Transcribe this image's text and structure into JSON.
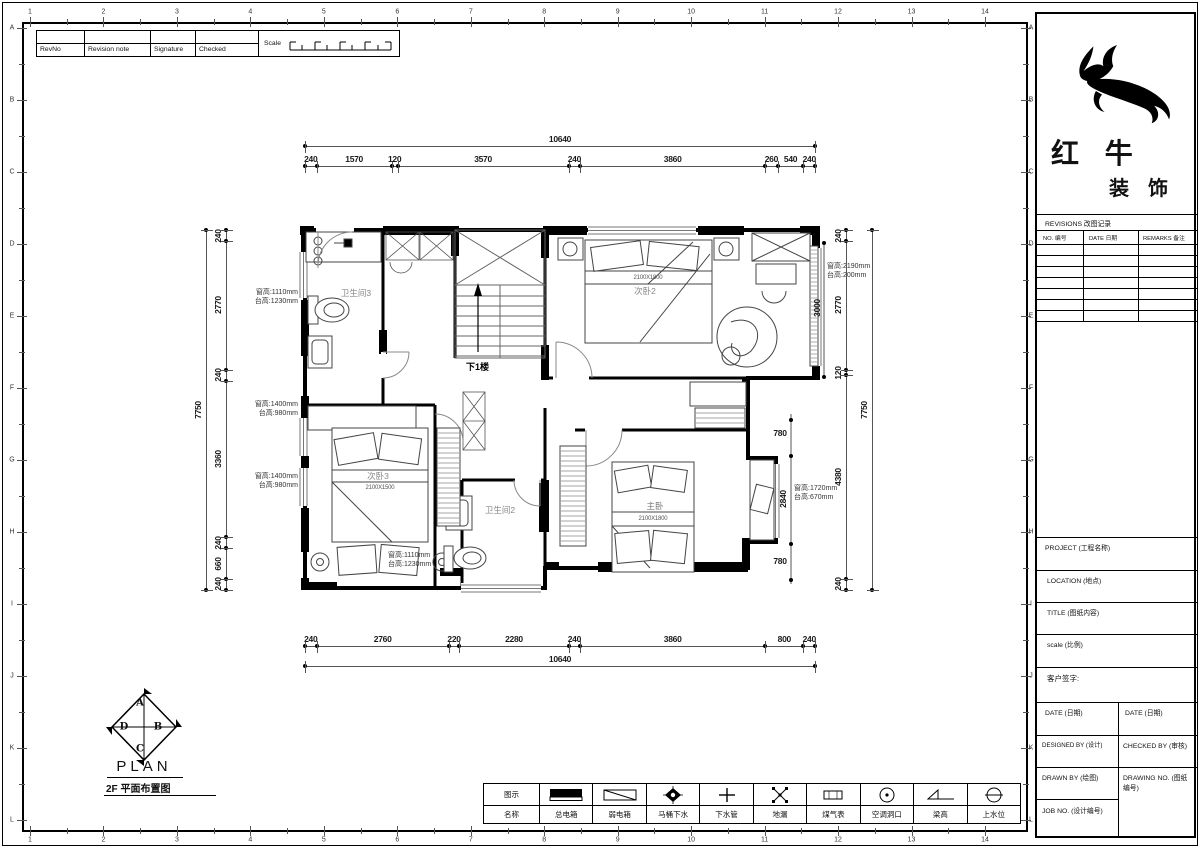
{
  "sheet": {
    "grid_cols": [
      "1",
      "2",
      "3",
      "4",
      "5",
      "6",
      "7",
      "8",
      "9",
      "10",
      "11",
      "12",
      "13",
      "14"
    ],
    "grid_rows": [
      "A",
      "B",
      "C",
      "D",
      "E",
      "F",
      "G",
      "H",
      "I",
      "J",
      "K",
      "L"
    ],
    "revision_strip": {
      "rev_no": "RevNo",
      "revision_note": "Revision note",
      "signature": "Signature",
      "checked": "Checked",
      "scale": "Scale"
    }
  },
  "title_block": {
    "company_line1": "红 牛",
    "company_line2": "装 饰",
    "revisions_title": "REVISIONS 改图记录",
    "rev_no_col": "NO. 编号",
    "rev_date_col": "DATE 日期",
    "rev_remarks_col": "REMARKS 备注",
    "project": "PROJECT (工程名称)",
    "location": "LOCATION (地点)",
    "title": "TITLE (图纸内容)",
    "scale": "scale (比例)",
    "client_signature": "客户签字:",
    "date_left": "DATE (日期)",
    "date_right": "DATE (日期)",
    "designed_by": "DESIGNED BY (设计)",
    "checked_by": "CHECKED BY (审核)",
    "drawn_by": "DRAWN BY (绘图)",
    "drawing_no": "DRAWING NO. (图纸编号)",
    "job_no": "JOB NO. (设计编号)"
  },
  "legend": {
    "symbol_header": "图示",
    "name_header": "名称",
    "items": [
      {
        "name": "总电箱",
        "icon": "main-electric-box"
      },
      {
        "name": "弱电箱",
        "icon": "weak-electric-box"
      },
      {
        "name": "马桶下水",
        "icon": "toilet-drain"
      },
      {
        "name": "下水管",
        "icon": "drain-pipe"
      },
      {
        "name": "地漏",
        "icon": "floor-drain"
      },
      {
        "name": "煤气表",
        "icon": "gas-meter"
      },
      {
        "name": "空调洞口",
        "icon": "ac-hole"
      },
      {
        "name": "梁高",
        "icon": "beam-height"
      },
      {
        "name": "上水位",
        "icon": "water-supply"
      }
    ]
  },
  "plan": {
    "rooms": {
      "bath3": "卫生间3",
      "bed2": "次卧2",
      "bed3": "次卧3",
      "bath2": "卫生间2",
      "master": "主卧",
      "stairs": "下1楼"
    },
    "bed_sizes": {
      "bed2": "2100X1800",
      "bed3": "2100X1500",
      "master": "2100X1800"
    },
    "window_notes": {
      "bath3_left": {
        "line1": "窗高:1110mm",
        "line2": "台高:1230mm"
      },
      "bed3_left_upper": {
        "line1": "窗高:1400mm",
        "line2": "台高:980mm"
      },
      "bed3_left_lower": {
        "line1": "窗高:1400mm",
        "line2": "台高:980mm"
      },
      "bath2_bottom": {
        "line1": "窗高:1110mm",
        "line2": "台高:1230mm"
      },
      "bed2_right": {
        "line1": "窗高:2190mm",
        "line2": "台高:200mm"
      },
      "master_bay": {
        "line1": "窗高:1720mm",
        "line2": "台高:670mm"
      }
    },
    "footer": {
      "plan_label": "PLAN",
      "sub_label": "2F 平面布置图",
      "compass_top": "A",
      "compass_right": "B",
      "compass_bottom": "C",
      "compass_left": "D"
    }
  },
  "dimensions": {
    "top": {
      "overall": "10640",
      "segments": [
        "240",
        "1570",
        "120",
        "3570",
        "240",
        "3860",
        "260",
        "540",
        "240"
      ]
    },
    "bottom": {
      "overall": "10640",
      "segments": [
        "240",
        "2760",
        "220",
        "2280",
        "240",
        "3860",
        "800",
        "240"
      ]
    },
    "left": {
      "overall": "7750",
      "segments": [
        "240",
        "2770",
        "240",
        "3360",
        "240",
        "660",
        "240"
      ]
    },
    "right": {
      "overall": "7750",
      "segments": [
        "240",
        "2770",
        "120",
        "4380",
        "240"
      ]
    },
    "bed2_inner_height": "3000",
    "bay_top": "780",
    "bay_middle": "2840",
    "bay_bottom": "780"
  }
}
